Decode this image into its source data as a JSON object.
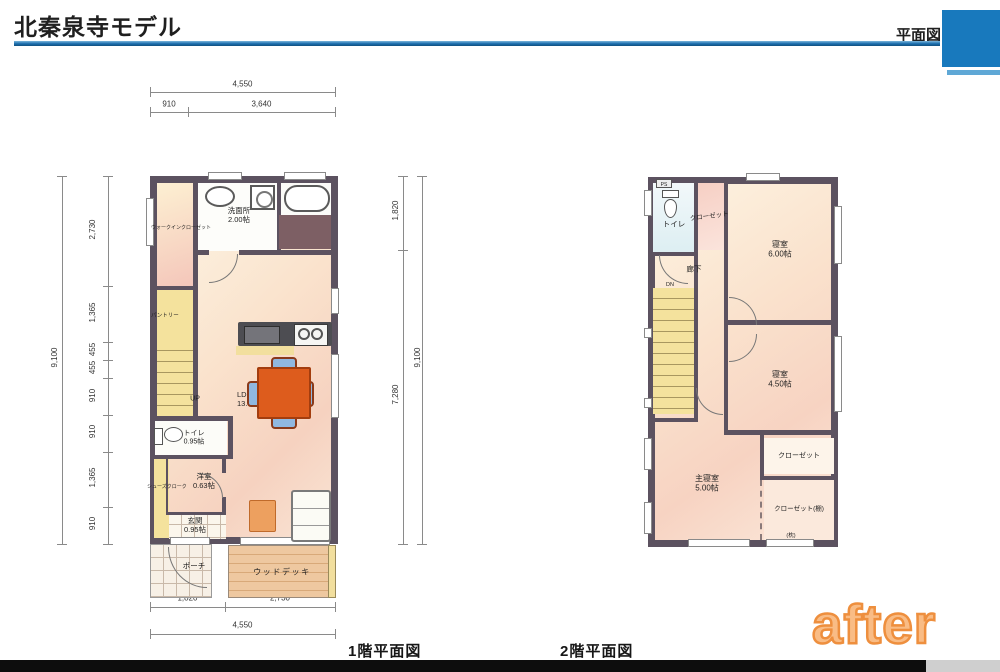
{
  "header": {
    "title": "北秦泉寺モデル",
    "plan_label": "平面図"
  },
  "floor1": {
    "caption": "1階平面図",
    "dims": {
      "top_total": "4,550",
      "top": [
        "910",
        "3,640"
      ],
      "left_total": "9,100",
      "left": [
        "2,730",
        "1,365",
        "455",
        "455",
        "910",
        "910",
        "1,365",
        "910"
      ],
      "right": [
        "1,820",
        "7,280"
      ],
      "right_total": "9,100",
      "bottom": [
        "1,820",
        "2,730"
      ],
      "bottom_total": "4,550"
    },
    "rooms": {
      "wic": "ウォークインクローゼット",
      "washroom": "洗面所",
      "washroom_size": "2.00帖",
      "pantry": "パントリー",
      "up": "UP",
      "ldk": "LDK",
      "ldk_size": "13.68帖",
      "toilet": "トイレ",
      "toilet_size": "0.95帖",
      "shoe_closet": "シューズクローク",
      "western_room": "洋室",
      "western_room_size": "0.63帖",
      "entrance": "玄関",
      "entrance_size": "0.95帖",
      "porch": "ポーチ",
      "wood_deck": "ウッドデッキ"
    }
  },
  "floor2": {
    "caption": "2階平面図",
    "rooms": {
      "ps": "PS",
      "toilet": "トイレ",
      "closet1": "クローゼット",
      "bedroom1": "寝室",
      "bedroom1_size": "6.00帖",
      "hall": "廊下",
      "dn": "DN",
      "bedroom2": "寝室",
      "bedroom2_size": "4.50帖",
      "closet2": "クローゼット",
      "master": "主寝室",
      "master_size": "5.00帖",
      "closet3": "クローゼット(棚)",
      "pillow": "(枕)"
    }
  },
  "watermark": "after",
  "colors": {
    "accent_blue": "#1879bd",
    "accent_blue_light": "#5fa8d6",
    "wall": "#5c5260",
    "stairs_yellow": "#f4e29d",
    "deck_wood": "#eec8a0",
    "table_orange": "#dd5c1d",
    "chair_blue": "#90b8e0",
    "bath_floor": "#7d5f64",
    "counter_gray": "#4d4d52",
    "dim_line": "#8a8a8a",
    "text_dark": "#1f1f1f",
    "watermark_fill": "#f9bc85",
    "watermark_stroke": "#ee8f3e",
    "footer_black": "#0d0d0d"
  }
}
